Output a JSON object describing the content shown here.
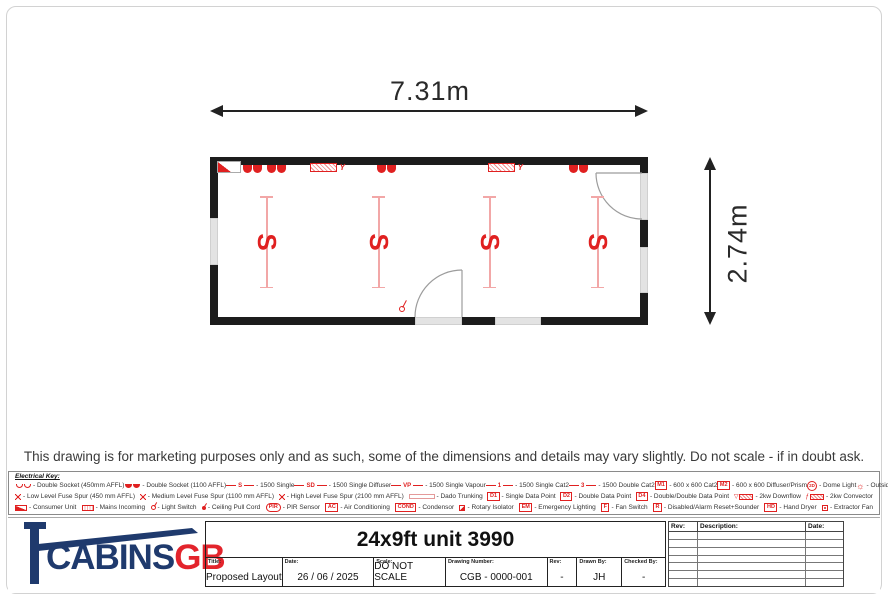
{
  "colors": {
    "red": "#e02020",
    "pink": "#f2a7a7",
    "navy": "#1f3a6d",
    "logored": "#e3242c",
    "wall": "#1c1c1c"
  },
  "disclaimer": "This drawing is for marketing purposes only and as such, some of the dimensions and details may vary slightly. Do not scale - if in doubt ask.",
  "plan": {
    "width_label": "7.31m",
    "height_label": "2.74m",
    "light_label": "S"
  },
  "electrical_key": {
    "title": "Electrical Key:",
    "rows": [
      [
        {
          "k": "humps-o",
          "l": "Double Socket (450mm AFFL)"
        },
        {
          "k": "humps-f",
          "l": "Double Socket (1100 AFFL)"
        },
        {
          "k": "line",
          "t": "S",
          "l": "1500 Single"
        },
        {
          "k": "line",
          "t": "SD",
          "l": "1500 Single Diffuser"
        },
        {
          "k": "line",
          "t": "VP",
          "l": "1500 Single Vapour"
        },
        {
          "k": "line",
          "t": "1",
          "l": "1500 Single Cat2"
        },
        {
          "k": "line",
          "t": "3",
          "l": "1500 Double Cat2"
        },
        {
          "k": "box",
          "t": "M1",
          "l": "600 x 600 Cat2"
        },
        {
          "k": "box",
          "t": "M2",
          "l": "600 x 600 Diffuser/Prism"
        },
        {
          "k": "circle",
          "t": "2D",
          "l": "Dome Light"
        },
        {
          "k": "rays",
          "l": "Outside Light"
        }
      ],
      [
        {
          "k": "spur",
          "l": "Low Level Fuse Spur (450 mm AFFL)"
        },
        {
          "k": "spur",
          "l": "Medium Level Fuse Spur (1100 mm AFFL)"
        },
        {
          "k": "spur",
          "l": "High Level Fuse Spur (2100 mm AFFL)"
        },
        {
          "k": "dado",
          "l": "Dado Trunking"
        },
        {
          "k": "box",
          "t": "D1",
          "l": "Single Data Point"
        },
        {
          "k": "box",
          "t": "D2",
          "l": "Double Data Point"
        },
        {
          "k": "box",
          "t": "D4",
          "l": "Double/Double Data Point"
        },
        {
          "k": "downflow",
          "l": "2kw Downflow"
        },
        {
          "k": "convector",
          "l": "2kw Convector"
        }
      ],
      [
        {
          "k": "consumer",
          "l": "Consumer Unit"
        },
        {
          "k": "mains",
          "l": "Mains Incoming"
        },
        {
          "k": "switch",
          "l": "Light Switch"
        },
        {
          "k": "pullcord",
          "l": "Ceiling Pull Cord"
        },
        {
          "k": "oval",
          "t": "PIR",
          "l": "PIR Sensor"
        },
        {
          "k": "box",
          "t": "AC",
          "l": "Air Conditioning"
        },
        {
          "k": "box",
          "t": "COND",
          "l": "Condensor"
        },
        {
          "k": "rotary",
          "l": "Rotary Isolator"
        },
        {
          "k": "box",
          "t": "EM",
          "l": "Emergency Lighting"
        },
        {
          "k": "box",
          "t": "F",
          "l": "Fan Switch"
        },
        {
          "k": "box",
          "t": "R",
          "l": "Disabled/Alarm Reset+Sounder"
        },
        {
          "k": "box",
          "t": "HD",
          "l": "Hand Dryer"
        },
        {
          "k": "extractor",
          "l": "Extractor Fan"
        }
      ]
    ]
  },
  "title_block": {
    "logo_cabins": "CABINS",
    "logo_gb": "GB",
    "drawing_title": "24x9ft unit 3990",
    "fields": [
      {
        "label": "Title:",
        "value": "Proposed Layout"
      },
      {
        "label": "Date:",
        "value": "26 / 06 / 2025"
      },
      {
        "label": "Scale:",
        "value": "DO NOT SCALE"
      },
      {
        "label": "Drawing Number:",
        "value": "CGB - 0000-001"
      },
      {
        "label": "Rev:",
        "value": "-"
      },
      {
        "label": "Drawn By:",
        "value": "JH"
      },
      {
        "label": "Checked By:",
        "value": "-"
      }
    ],
    "revision_table": {
      "headers": [
        "Rev:",
        "Description:",
        "Date:"
      ],
      "empty_row_count": 7
    }
  }
}
